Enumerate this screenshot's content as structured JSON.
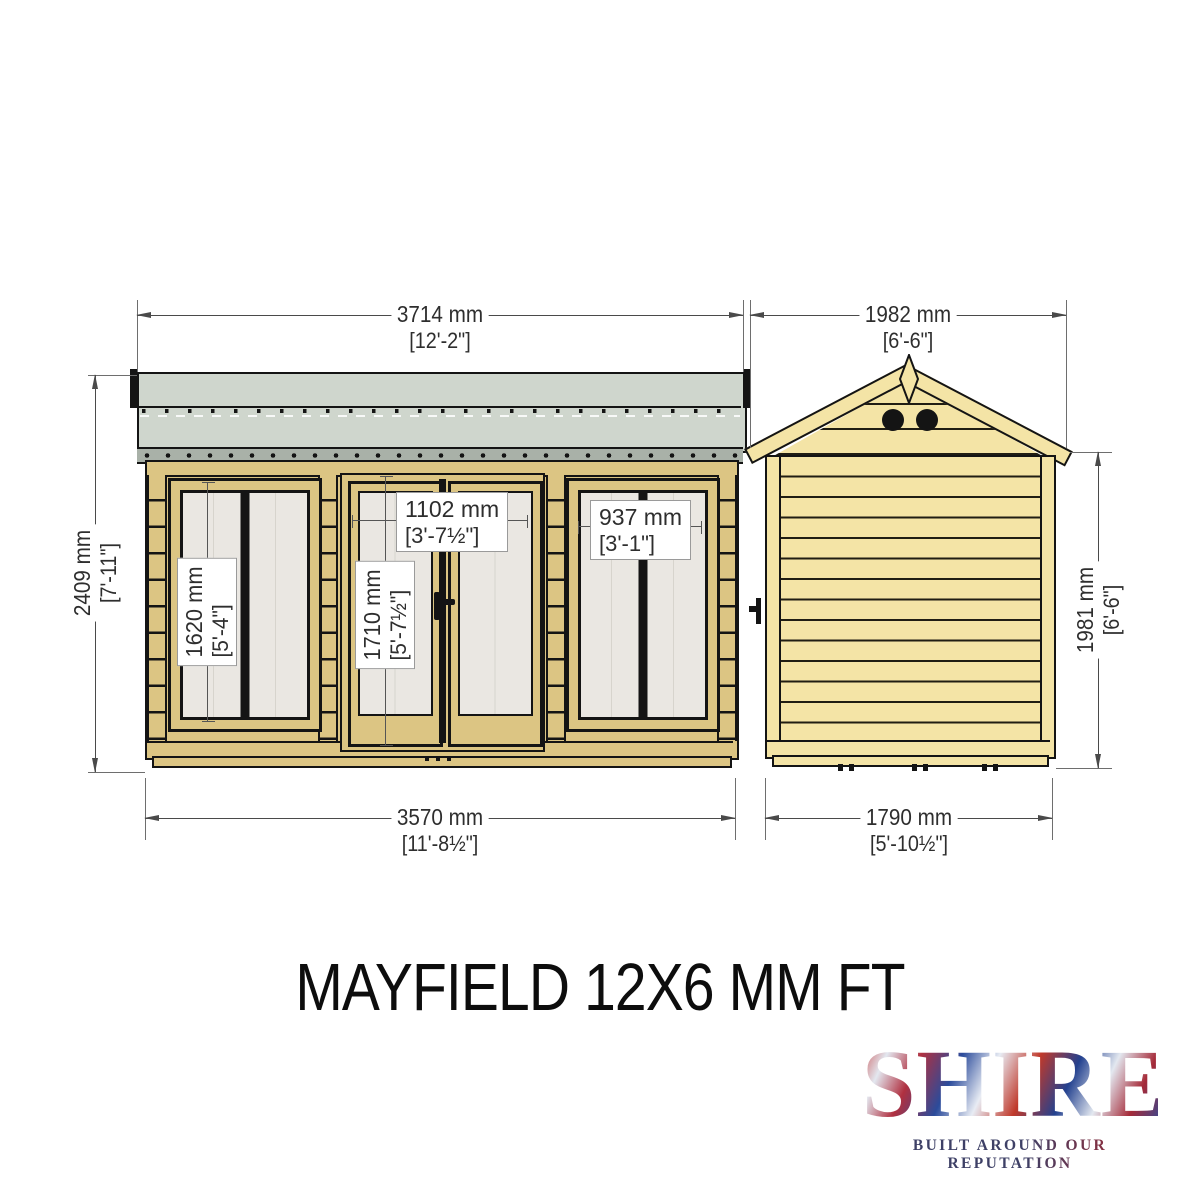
{
  "title": "MAYFIELD 12X6 MM FT",
  "brand": {
    "logo_text": "SHIRE",
    "tagline": "BUILT AROUND OUR REPUTATION"
  },
  "front_elevation": {
    "label": "front elevation",
    "dims": {
      "overall_width_top": {
        "mm": "3714 mm",
        "ftin": "[12'-2\"]"
      },
      "overall_height_left": {
        "mm": "2409 mm",
        "ftin": "[7'-11\"]"
      },
      "base_width_bottom": {
        "mm": "3570 mm",
        "ftin": "[11'-8½\"]"
      },
      "door_opening_width": {
        "mm": "1102 mm",
        "ftin": "[3'-7½\"]"
      },
      "window_width": {
        "mm": "937 mm",
        "ftin": "[3'-1\"]"
      },
      "window_height": {
        "mm": "1620 mm",
        "ftin": "[5'-4\"]"
      },
      "door_height": {
        "mm": "1710 mm",
        "ftin": "[5'-7½\"]"
      }
    }
  },
  "side_elevation": {
    "label": "side elevation",
    "dims": {
      "roof_width_top": {
        "mm": "1982 mm",
        "ftin": "[6'-6\"]"
      },
      "wall_height_right": {
        "mm": "1981 mm",
        "ftin": "[6'-6\"]"
      },
      "base_width_bottom": {
        "mm": "1790 mm",
        "ftin": "[5'-10½\"]"
      }
    }
  },
  "colors": {
    "timber": "#dcc583",
    "timber_pale": "#f4e4a6",
    "roof_felt": "#cfd6cd",
    "fascia": "#a9b1a8",
    "glazing": "#eae7e2",
    "outline": "#141414",
    "dimension": "#4a4a4a"
  }
}
